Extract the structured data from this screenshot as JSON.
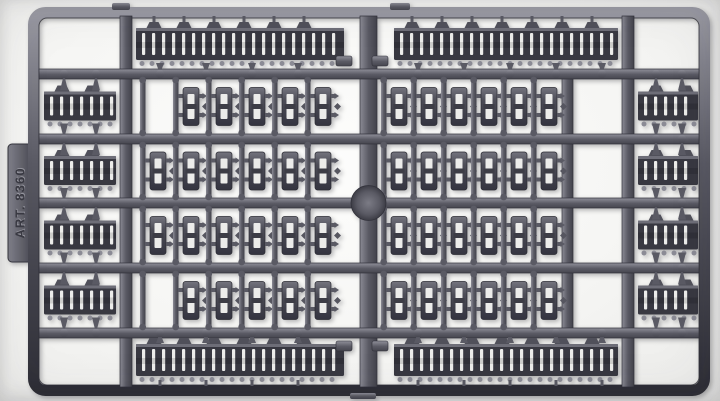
{
  "photo": {
    "subject": "gray plastic model-kit sprue with tank track links",
    "background_color": "#f5f5f3"
  },
  "sprue": {
    "part_number_label": "ART. 8360",
    "colors": {
      "plastic_base": "#5a5a64",
      "plastic_light": "#9a9aa3",
      "plastic_mid": "#6e6e78",
      "plastic_dark": "#383841",
      "plastic_darker": "#2e2e36",
      "rib_gap": "#ececea",
      "knob": "#8b8b95",
      "emboss_dark": "#3a3a43",
      "emboss_light": "#a6a6af"
    },
    "structure": {
      "track_length_rows": [
        {
          "position": "top",
          "segments": 2
        },
        {
          "position": "bottom",
          "segments": 2
        }
      ],
      "link_rows": [
        {
          "left_links": 5,
          "left_empty_slot": true,
          "right_links": 6
        },
        {
          "left_links": 6,
          "left_empty_slot": false,
          "right_links": 6
        },
        {
          "left_links": 6,
          "left_empty_slot": false,
          "right_links": 6
        },
        {
          "left_links": 5,
          "left_empty_slot": true,
          "right_links": 6
        }
      ],
      "side_track_sections": {
        "left_column": 4,
        "right_column": 4
      }
    }
  }
}
